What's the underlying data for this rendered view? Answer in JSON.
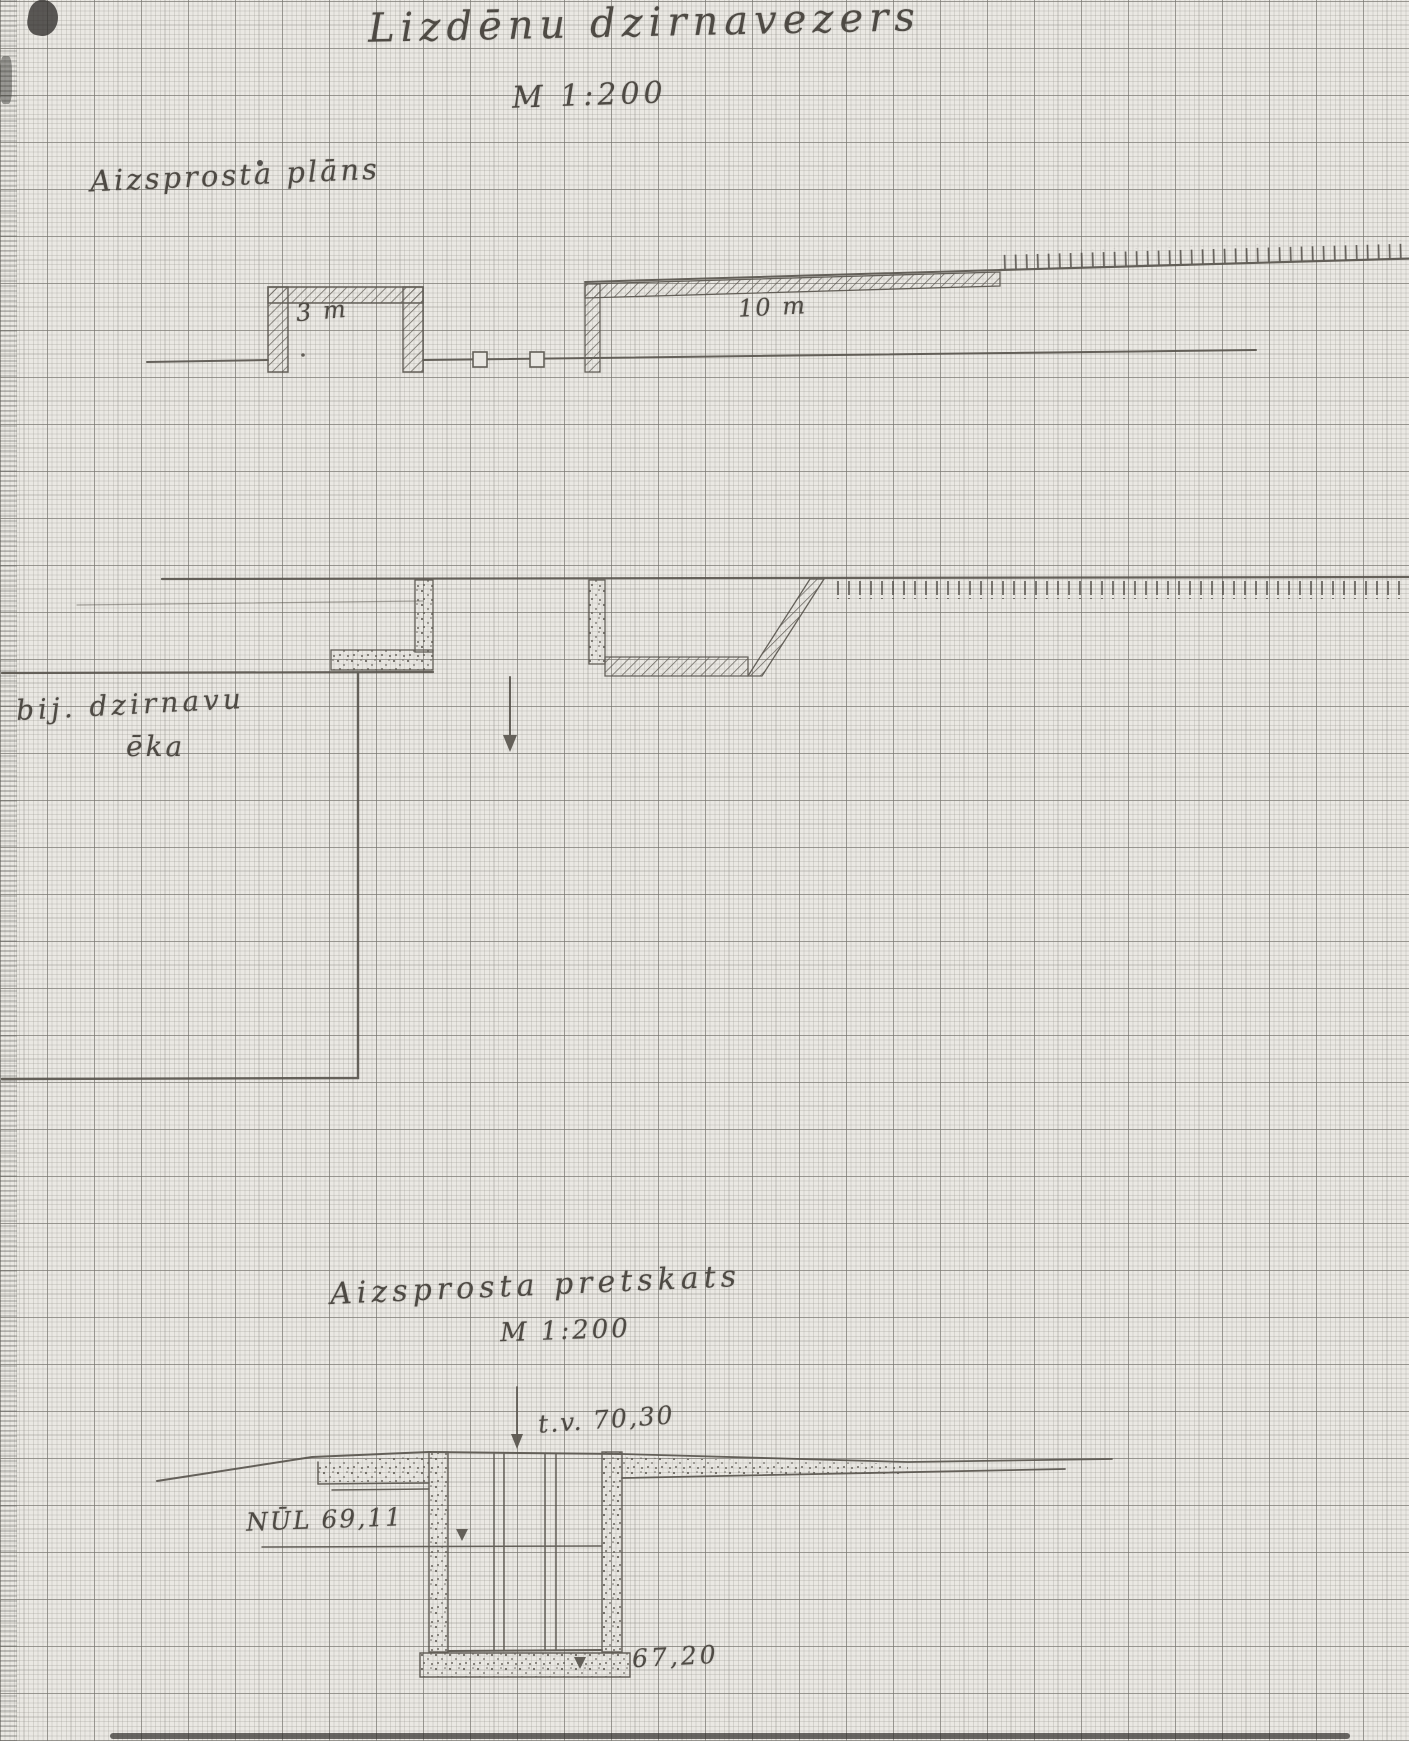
{
  "page": {
    "title": "Lizdēnu dzirnavezers",
    "scale": "M 1:200"
  },
  "plan_view": {
    "label": "Aizsprosta plāns",
    "intake_width": "3 m",
    "spillway_width": "10 m",
    "building_label_line1": "bij. dzirnavu",
    "building_label_line2": "ēka"
  },
  "front_view": {
    "label": "Aizsprosta pretskats",
    "scale": "M 1:200",
    "crest_level": "t.v. 70,30",
    "normal_water_level": "NŪL 69,11",
    "bottom_level": "67,20"
  },
  "colors": {
    "pencil": "#56524b",
    "paper": "#eae8e3",
    "grid_fine": "#949286",
    "grid_bold": "#74726c"
  }
}
